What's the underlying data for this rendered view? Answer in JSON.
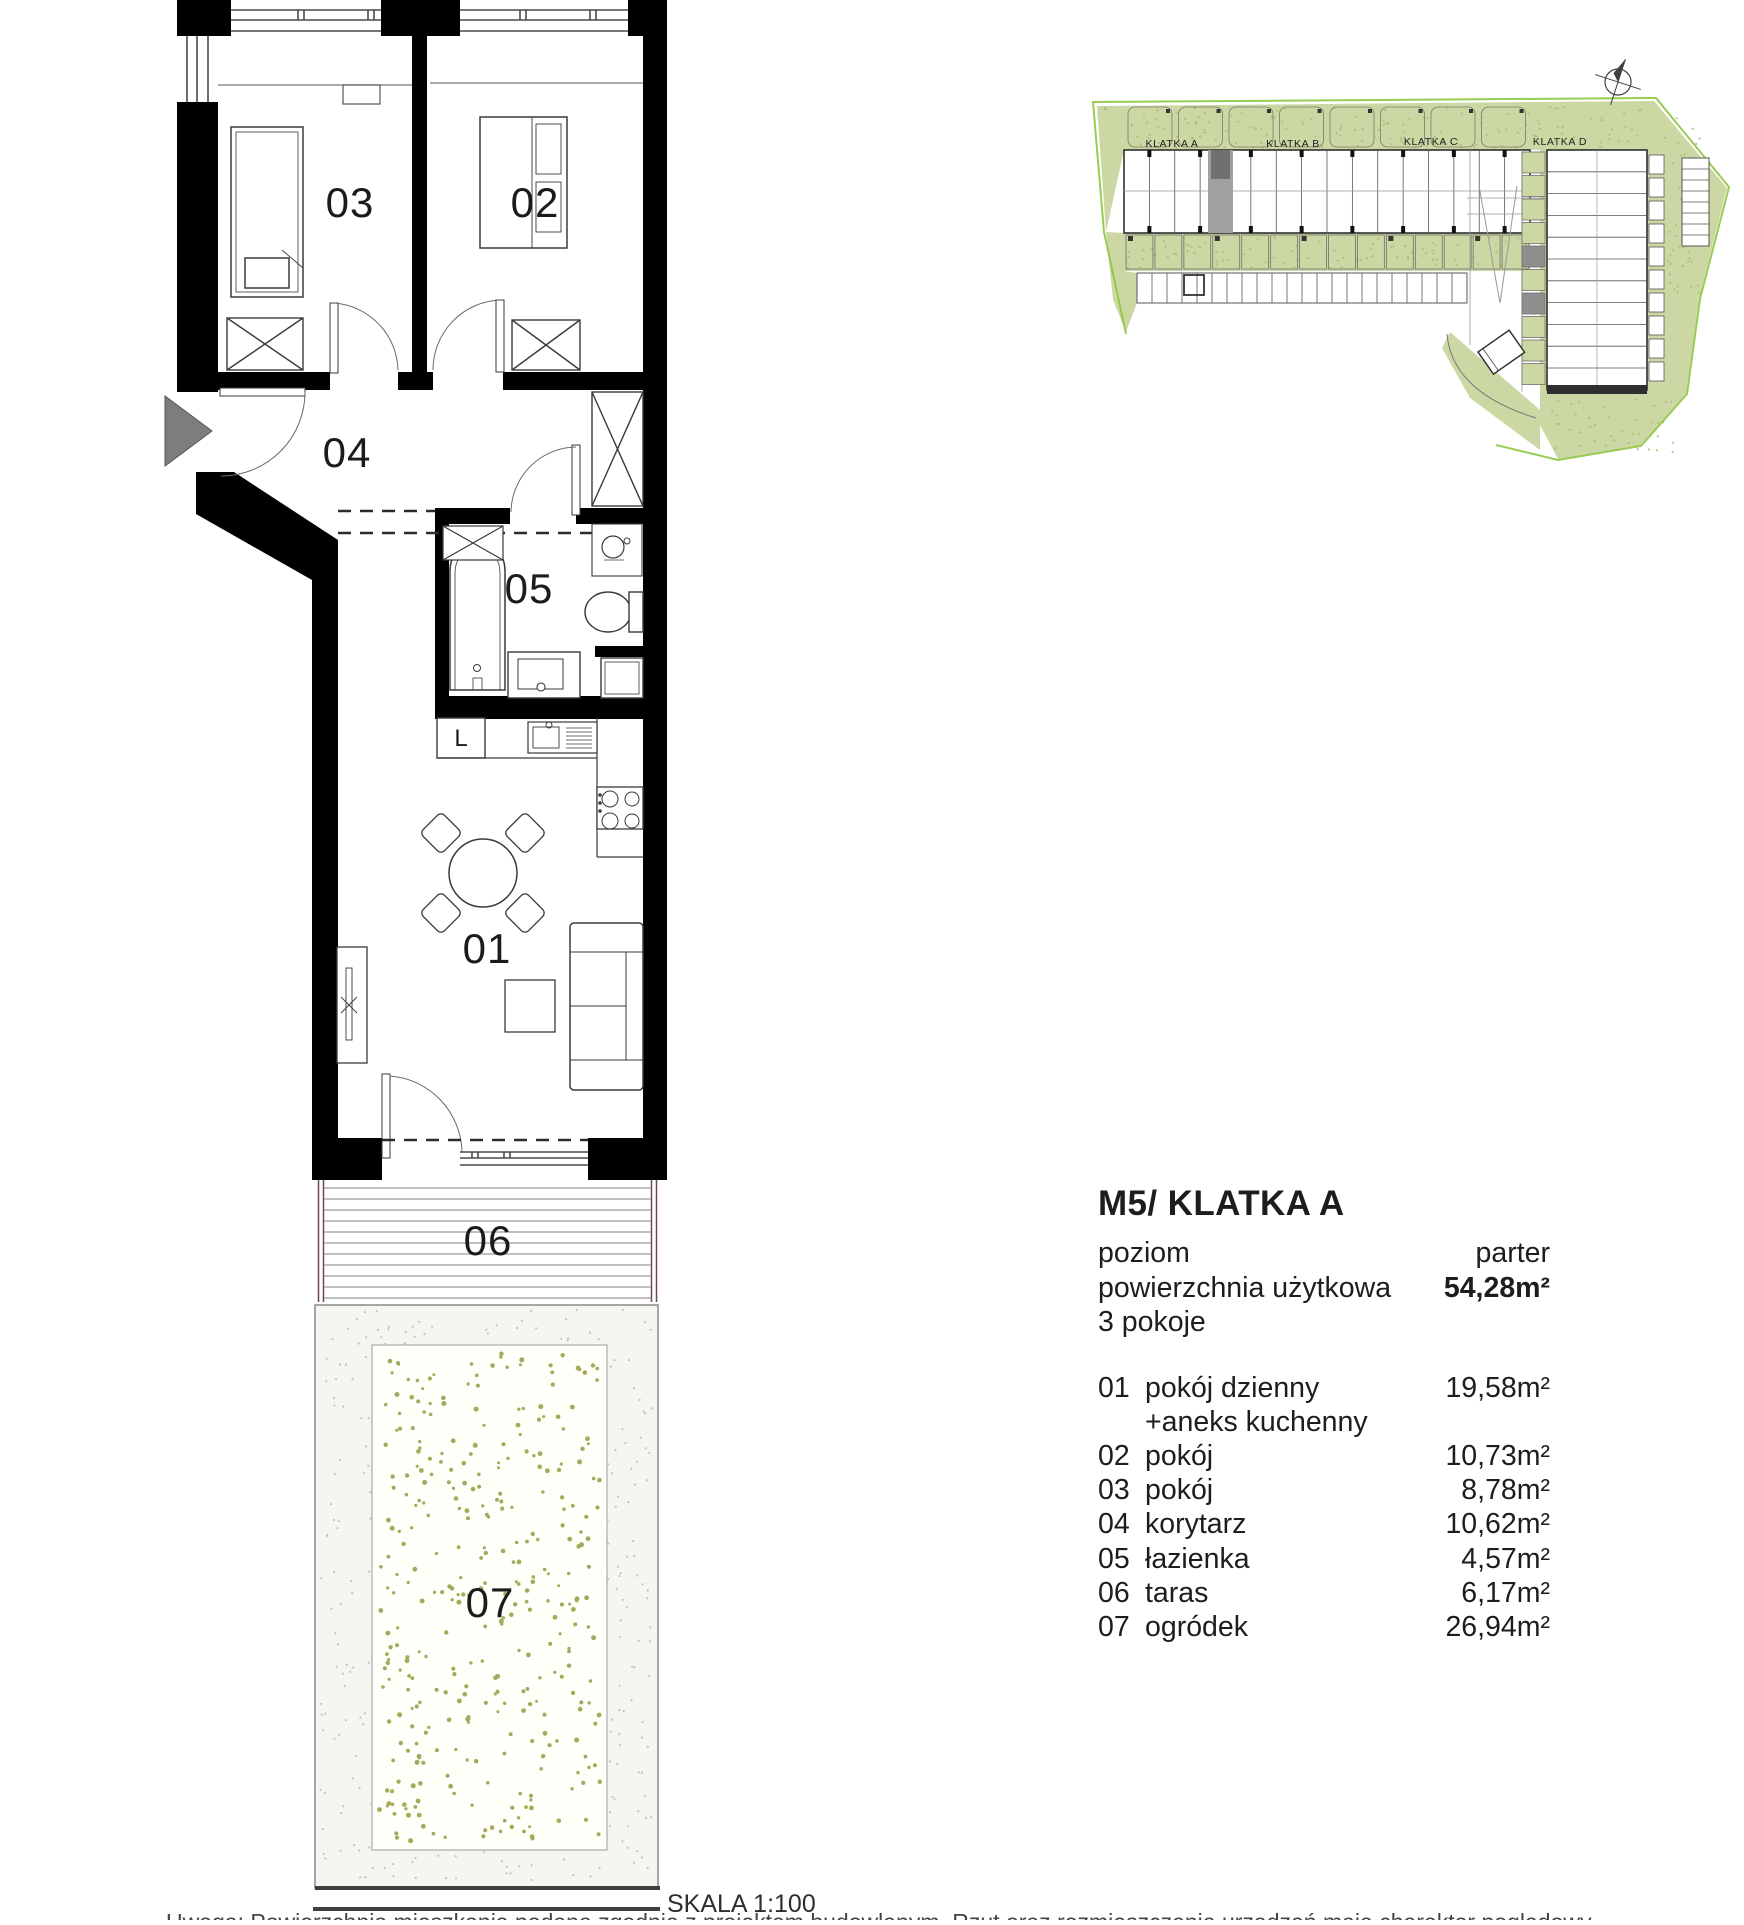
{
  "plan": {
    "room_labels": {
      "r01": "01",
      "r02": "02",
      "r03": "03",
      "r04": "04",
      "r05": "05",
      "r06": "06",
      "r07": "07"
    },
    "fridge_label": "L"
  },
  "site_plan": {
    "klatka_a": "KLATKA A",
    "klatka_b": "KLATKA B",
    "klatka_c": "KLATKA C",
    "klatka_d": "KLATKA D"
  },
  "info_panel": {
    "title": "M5/ KLATKA A",
    "summary_rows": [
      {
        "label": "poziom",
        "value": "parter"
      },
      {
        "label": "powierzchnia użytkowa",
        "value": "54,28m²"
      },
      {
        "label": "3 pokoje",
        "value": ""
      }
    ],
    "room_rows": [
      {
        "no": "01",
        "name": "pokój dzienny",
        "extra": "+aneks kuchenny",
        "area": "19,58m²"
      },
      {
        "no": "02",
        "name": "pokój",
        "area": "10,73m²"
      },
      {
        "no": "03",
        "name": "pokój",
        "area": "8,78m²"
      },
      {
        "no": "04",
        "name": "korytarz",
        "area": "10,62m²"
      },
      {
        "no": "05",
        "name": "łazienka",
        "area": "4,57m²"
      },
      {
        "no": "06",
        "name": "taras",
        "area": "6,17m²"
      },
      {
        "no": "07",
        "name": "ogródek",
        "area": "26,94m²"
      }
    ]
  },
  "footer": {
    "scale_label": "SKALA 1:100",
    "note": "Uwaga: Powierzchnia mieszkania podana zgodnie z projektem budowlanym. Rzut oraz rozmieszczenie urządzeń mają charakter poglądowy."
  },
  "colors": {
    "wall": "#000000",
    "site_green": "#ccd8a4",
    "boundary_green": "#8dc63f",
    "highlight_gray": "#a0a0a0",
    "terrace_rail": "#6d4c41"
  }
}
